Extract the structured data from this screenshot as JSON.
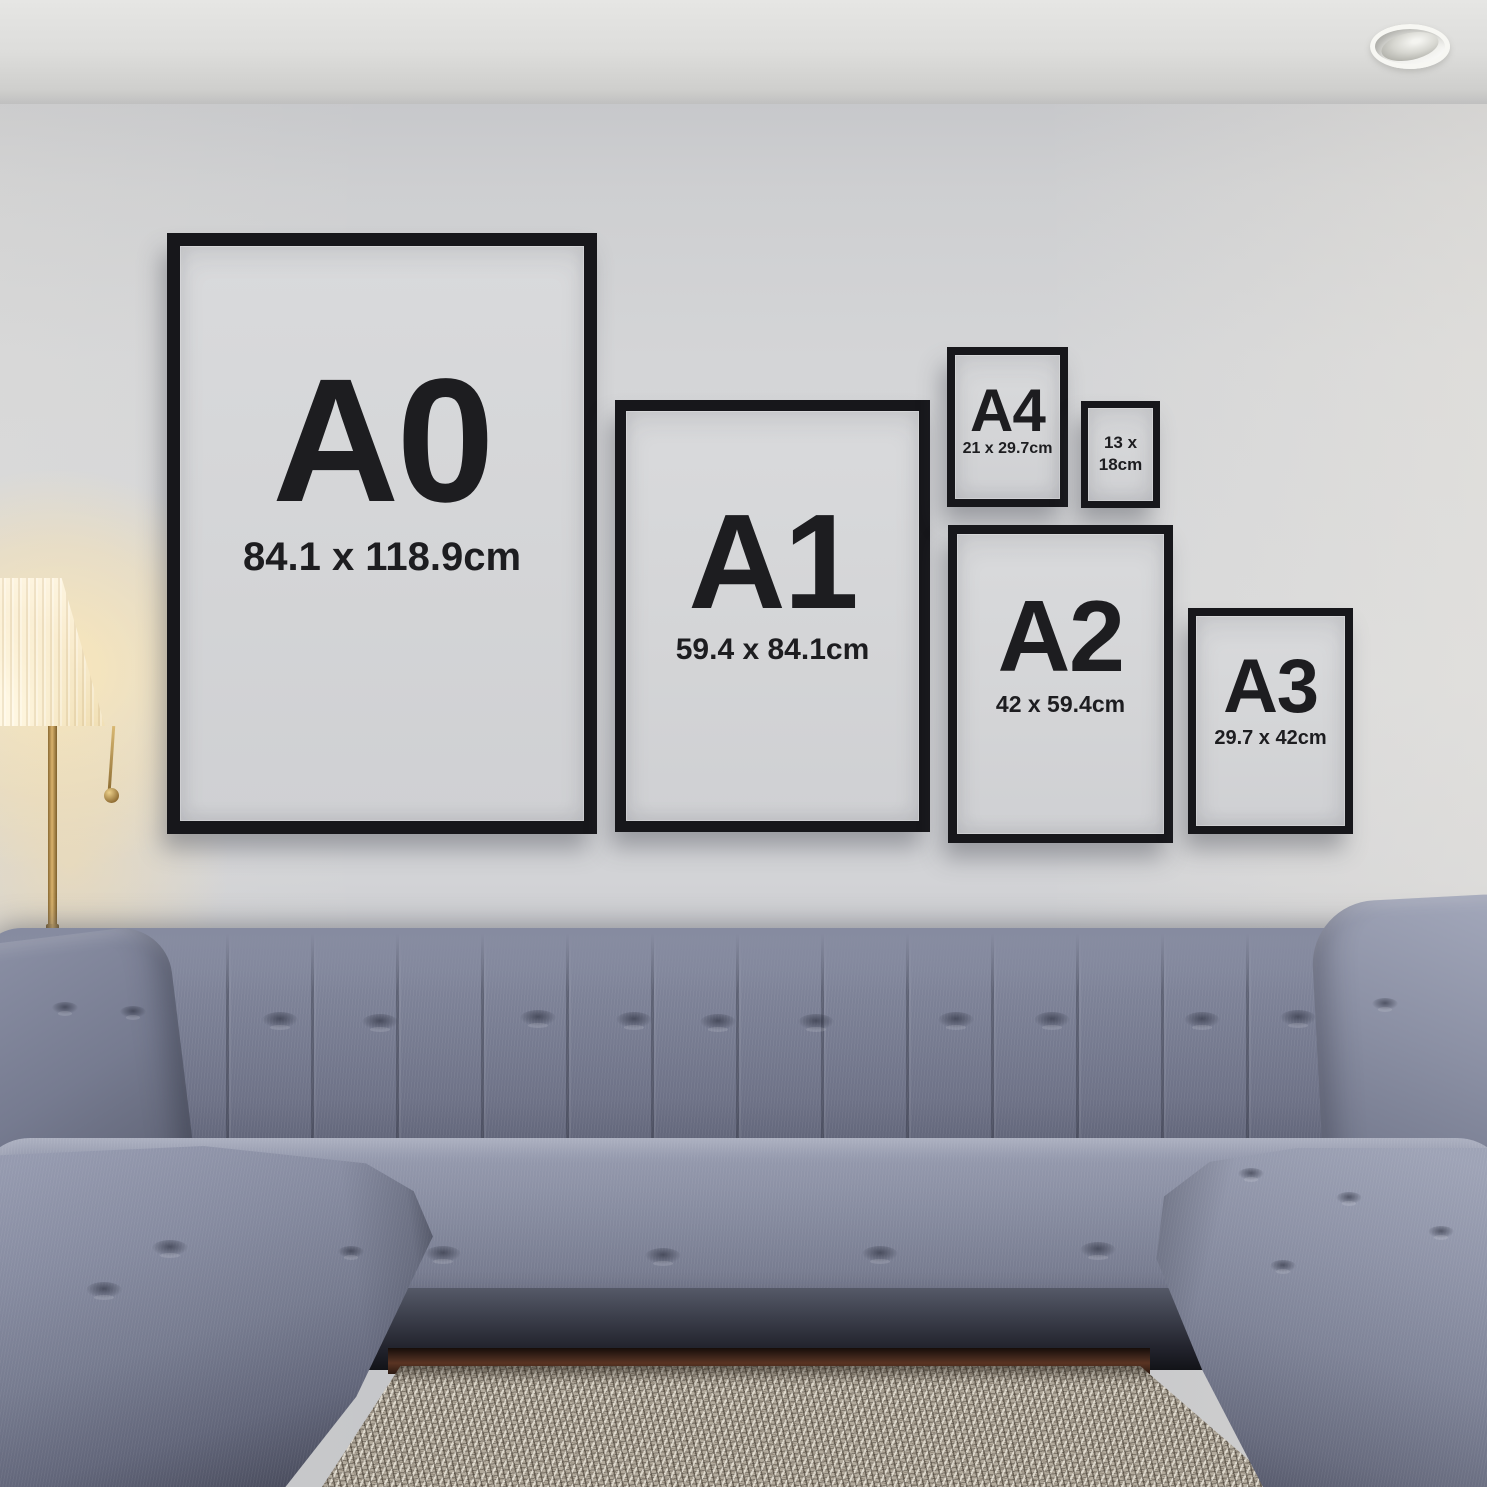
{
  "frames": [
    {
      "id": "a0",
      "size_code": "A0",
      "dimensions": "84.1 x 118.9cm"
    },
    {
      "id": "a1",
      "size_code": "A1",
      "dimensions": "59.4 x 84.1cm"
    },
    {
      "id": "a4",
      "size_code": "A4",
      "dimensions": "21 x 29.7cm"
    },
    {
      "id": "13x18",
      "dimensions_line1": "13 x",
      "dimensions_line2": "18cm"
    },
    {
      "id": "a2",
      "size_code": "A2",
      "dimensions": "42 x 59.4cm"
    },
    {
      "id": "a3",
      "size_code": "A3",
      "dimensions": "29.7 x 42cm"
    }
  ],
  "colors": {
    "frame_border": "#17171b",
    "frame_mat": "#d4d5d7",
    "label_text": "#1d1d20",
    "wall": "#d2d3d5",
    "ceiling": "#e0e0de",
    "sofa_fabric": "#767b90",
    "sofa_shadow": "#4b4e5f",
    "rug": "#b3ab9d",
    "wood_floor": "#44291d",
    "lamp_shade": "#f9ecce",
    "lamp_glow": "#ffe4ae",
    "lamp_brass": "#b08d4f"
  }
}
